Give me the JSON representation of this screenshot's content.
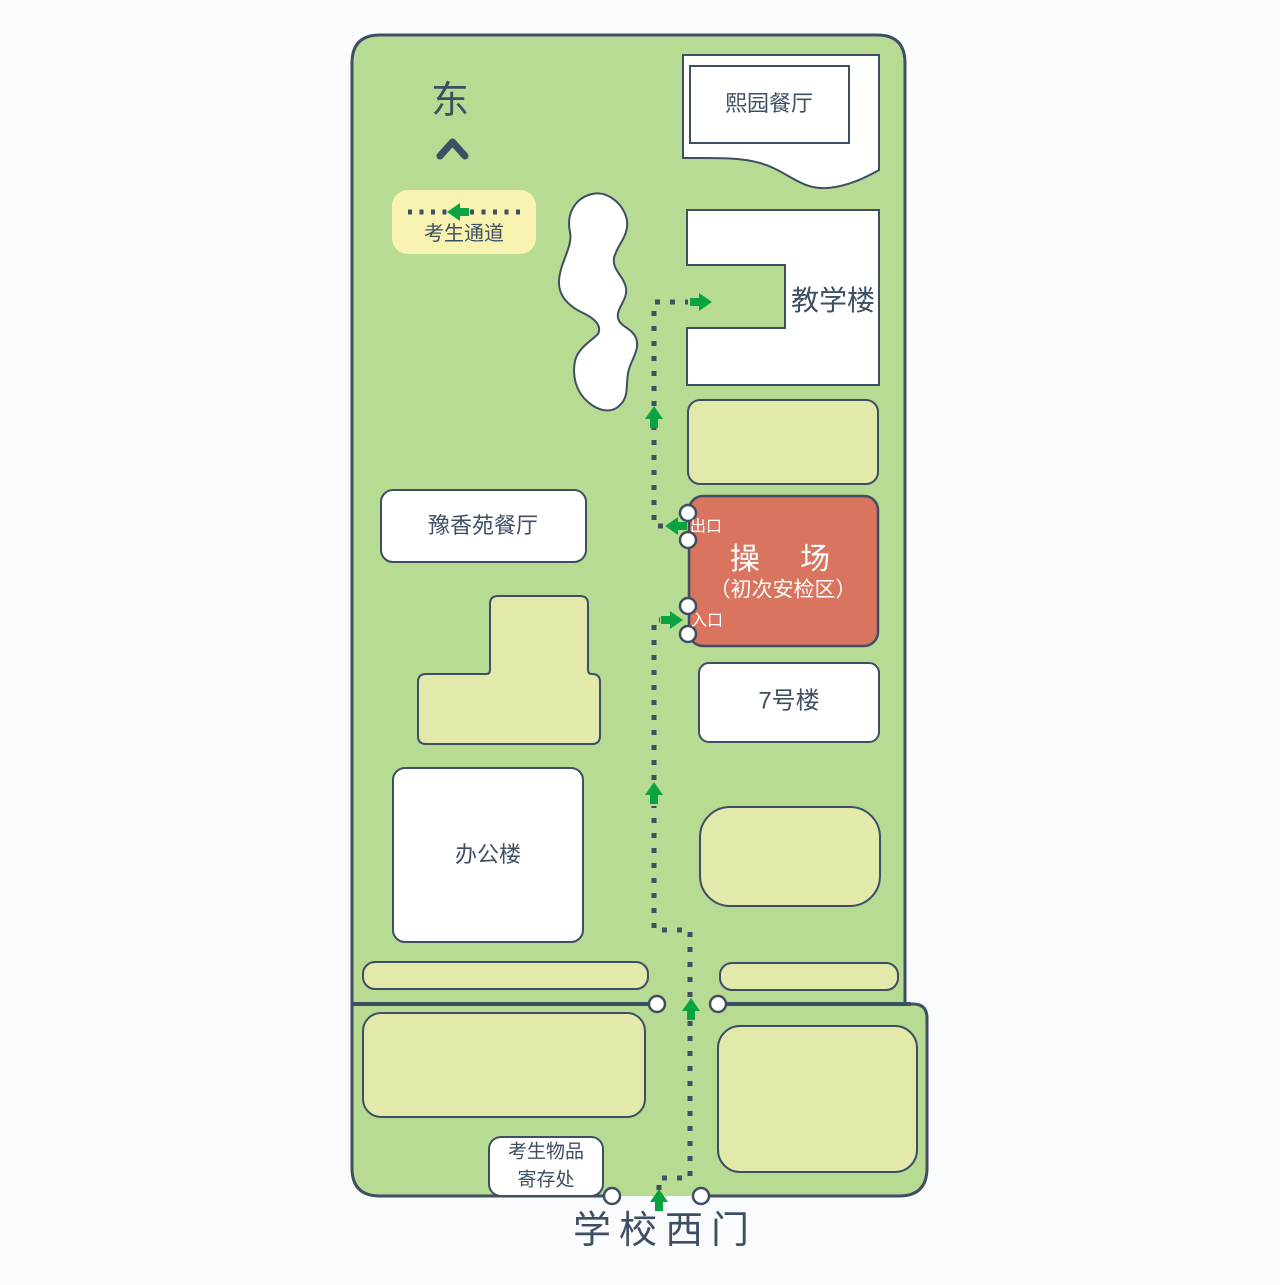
{
  "map": {
    "orientation": {
      "label": "东",
      "icon": "chevron-up-icon"
    },
    "legend": {
      "label": "考生通道",
      "icon": "dotted-route-arrow-left-icon"
    },
    "buildings": {
      "xiyuan": "熙园餐厅",
      "teaching": "教学楼",
      "yuxiangyuan": "豫香苑餐厅",
      "no7": "7号楼",
      "office": "办公楼"
    },
    "playground": {
      "title": "操 场",
      "subtitle": "（初次安检区）",
      "exit": "出口",
      "entrance": "入口"
    },
    "storage": {
      "line1": "考生物品",
      "line2": "寄存处"
    },
    "gate": {
      "label": "学校西门"
    },
    "route": {
      "arrow_icon": "route-arrow-icon",
      "marker_icon": "gate-marker-circle-icon"
    },
    "colors": {
      "page_background": "#fafbfc",
      "campus_green": "#b8db93",
      "annex_yellow": "#e2e9aa",
      "legend_yellow": "#f8f3b0",
      "building_white": "#ffffff",
      "outline_navy": "#3e4e63",
      "playground_red": "#d9745f",
      "route_green": "#0aa342"
    }
  }
}
